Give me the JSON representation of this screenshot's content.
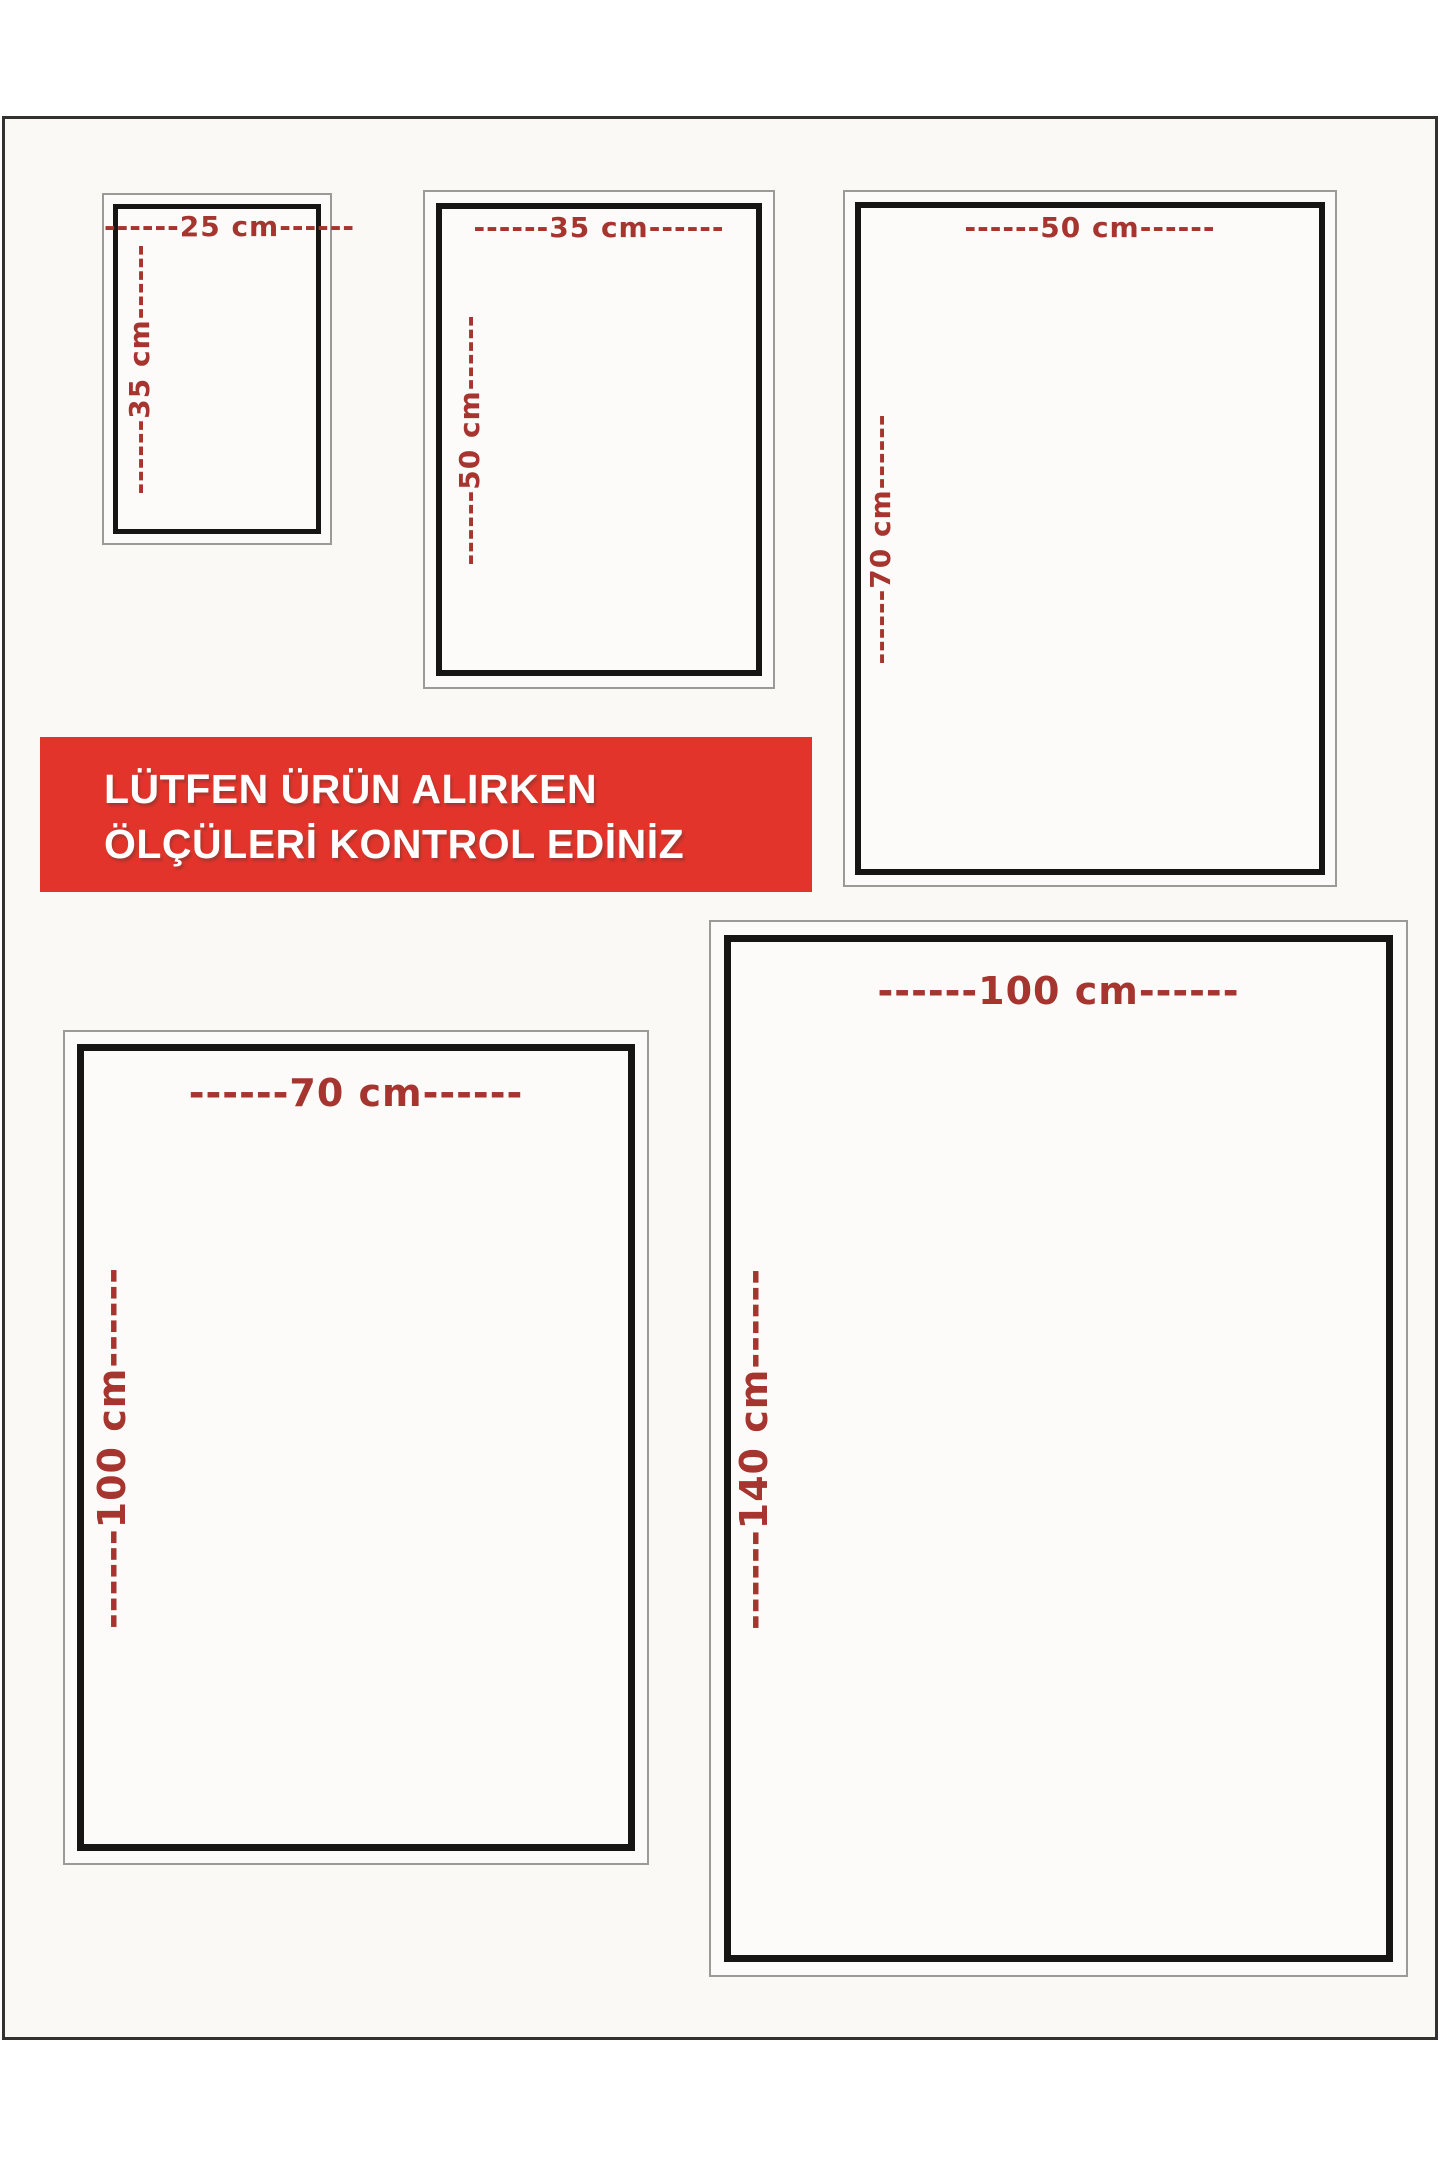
{
  "page": {
    "background_color": "#faf9f6",
    "frame_border_color": "#33312e"
  },
  "notice_banner": {
    "line1": "LÜTFEN ÜRÜN ALIRKEN",
    "line2": "ÖLÇÜLERİ KONTROL EDİNİZ",
    "background_color": "#e2342a",
    "text_color": "#ffffff"
  },
  "dimension_label_color": "#a5352e",
  "size_boxes": [
    {
      "name": "25x35",
      "width_cm": 25,
      "height_cm": 35,
      "width_label": "------25 cm------",
      "height_label": "------35 cm------"
    },
    {
      "name": "35x50",
      "width_cm": 35,
      "height_cm": 50,
      "width_label": "------35 cm------",
      "height_label": "------50 cm------"
    },
    {
      "name": "50x70",
      "width_cm": 50,
      "height_cm": 70,
      "width_label": "------50 cm------",
      "height_label": "------70 cm------"
    },
    {
      "name": "70x100",
      "width_cm": 70,
      "height_cm": 100,
      "width_label": "------70 cm------",
      "height_label": "------100 cm------"
    },
    {
      "name": "100x140",
      "width_cm": 100,
      "height_cm": 140,
      "width_label": "------100 cm------",
      "height_label": "------140 cm------"
    }
  ]
}
